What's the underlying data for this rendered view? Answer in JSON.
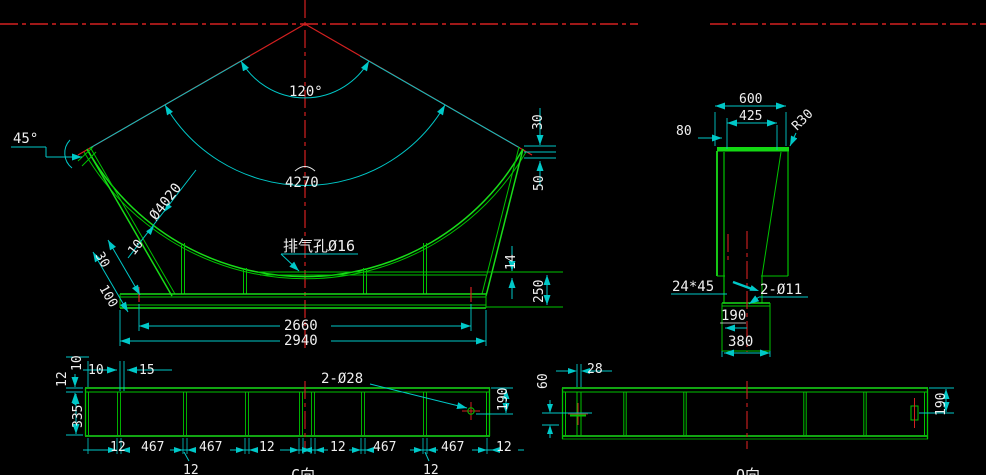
{
  "app": {
    "type": "cad-drawing-viewport",
    "background": "#000000"
  },
  "colors": {
    "part_green": "#00c300",
    "dimension_cyan": "#00c8c8",
    "centerline_red": "#d42020",
    "text_white": "#efefef"
  },
  "front_view": {
    "angle_120": "120°",
    "arc_4270": "4270",
    "dia_4020": "Ø4020",
    "thk_10": "10",
    "angle_45": "45°",
    "vent": "排气孔Ø16",
    "tip_30": "30",
    "tip_50": "50",
    "plate_14": "14",
    "h_250": "250",
    "edge_30": "30",
    "edge_100": "100",
    "w_2660": "2660",
    "w_2940": "2940"
  },
  "side_view": {
    "w_600": "600",
    "w_425": "425",
    "o_80": "80",
    "radius": "R30",
    "chamfer": "24*45",
    "holes": "2-Ø11",
    "half_190": "190",
    "base_380": "380"
  },
  "beam_c": {
    "label": "C向",
    "top_10": "10",
    "top_15": "15",
    "v_10": "10",
    "v_12": "12",
    "v_335": "335",
    "holes": "2-Ø28",
    "r_190": "190",
    "chain": [
      "12",
      "467",
      "467",
      "12",
      "12",
      "467",
      "467",
      "12"
    ],
    "leader_a": "12",
    "leader_b": "12"
  },
  "beam_q": {
    "label": "Q向",
    "d_60": "60",
    "d_28": "28",
    "r_190": "190"
  }
}
